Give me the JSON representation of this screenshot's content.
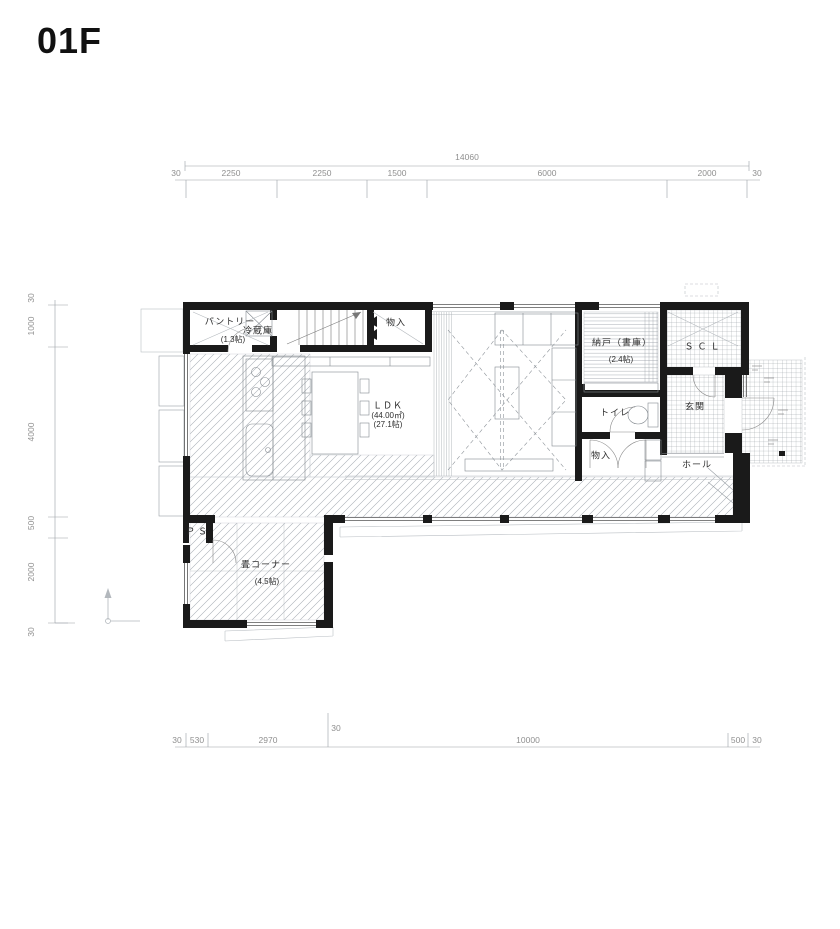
{
  "title": "01F",
  "colors": {
    "wall": "#1a1a1a",
    "line": "#777777",
    "dim_text": "#8f8f8f",
    "hatch": "#a8adb3"
  },
  "dimensions": {
    "top": {
      "total": "14060",
      "labels": [
        "30",
        "2250",
        "2250",
        "1500",
        "6000",
        "2000",
        "30"
      ]
    },
    "left": {
      "labels": [
        "30",
        "1000",
        "4000",
        "500",
        "2000",
        "30"
      ]
    },
    "bottom": {
      "labels": [
        "30",
        "530",
        "2970",
        "10000",
        "500",
        "30"
      ],
      "inner": "30"
    }
  },
  "rooms": {
    "pantry": {
      "name": "パントリー",
      "fridge": "冷蔵庫",
      "size": "(1.3帖)"
    },
    "closet_top": {
      "name": "物入"
    },
    "storage": {
      "name": "納戸（書庫）",
      "size": "(2.4帖)"
    },
    "scl": {
      "name": "ＳＣＬ"
    },
    "toilet": {
      "name": "トイレ"
    },
    "entrance": {
      "name": "玄関"
    },
    "hall": {
      "name": "ホール"
    },
    "closet_lower": {
      "name": "物入"
    },
    "ldk": {
      "name": "ＬＤＫ",
      "area": "(44.00㎡)",
      "size": "(27.1帖)"
    },
    "ps": {
      "name": "ＰＳ"
    },
    "tatami": {
      "name": "畳コーナー",
      "size": "(4.5帖)"
    }
  }
}
